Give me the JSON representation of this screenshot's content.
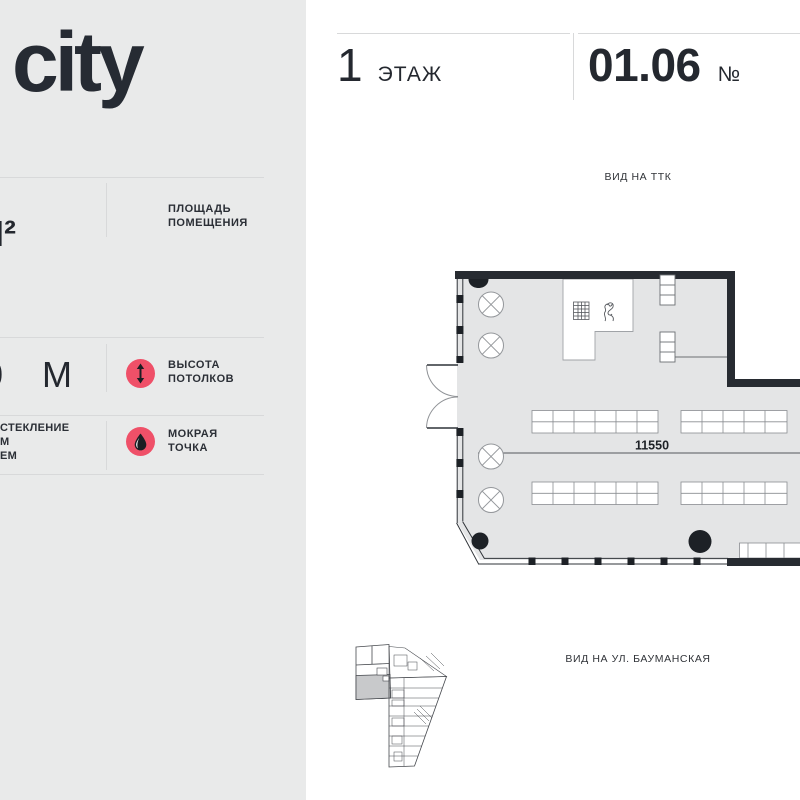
{
  "brand": {
    "logo_text": "city"
  },
  "header": {
    "floor_value": "1",
    "floor_label": "ЭТАЖ",
    "unit_value": "01.06",
    "unit_label": "№"
  },
  "sidebar": {
    "area_section": {
      "value": "М²",
      "label_line1": "ПЛОЩАДЬ",
      "label_line2": "ПОМЕЩЕНИЯ"
    },
    "height_section": {
      "value_fragment": "0",
      "value": "М",
      "label_line1": "ВЫСОТА",
      "label_line2": "ПОТОЛКОВ"
    },
    "glazing_section": {
      "line1": "СТЕКЛЕНИЕ",
      "line2": "М",
      "line3": "ЕМ"
    },
    "wet_section": {
      "label_line1": "МОКРАЯ",
      "label_line2": "ТОЧКА"
    },
    "icons": {
      "height": "vertical-arrows-icon",
      "wet": "water-drop-icon"
    }
  },
  "plan": {
    "view_label_top": "ВИД НА ТТК",
    "view_label_bottom": "ВИД НА УЛ. БАУМАНСКАЯ",
    "dimension_label": "11550"
  },
  "colors": {
    "accent": "#ef5068",
    "sidebar_bg": "#e9eaea",
    "wall": "#272b31",
    "floor_fill": "#e4e5e6",
    "text_dark": "#24282f"
  }
}
